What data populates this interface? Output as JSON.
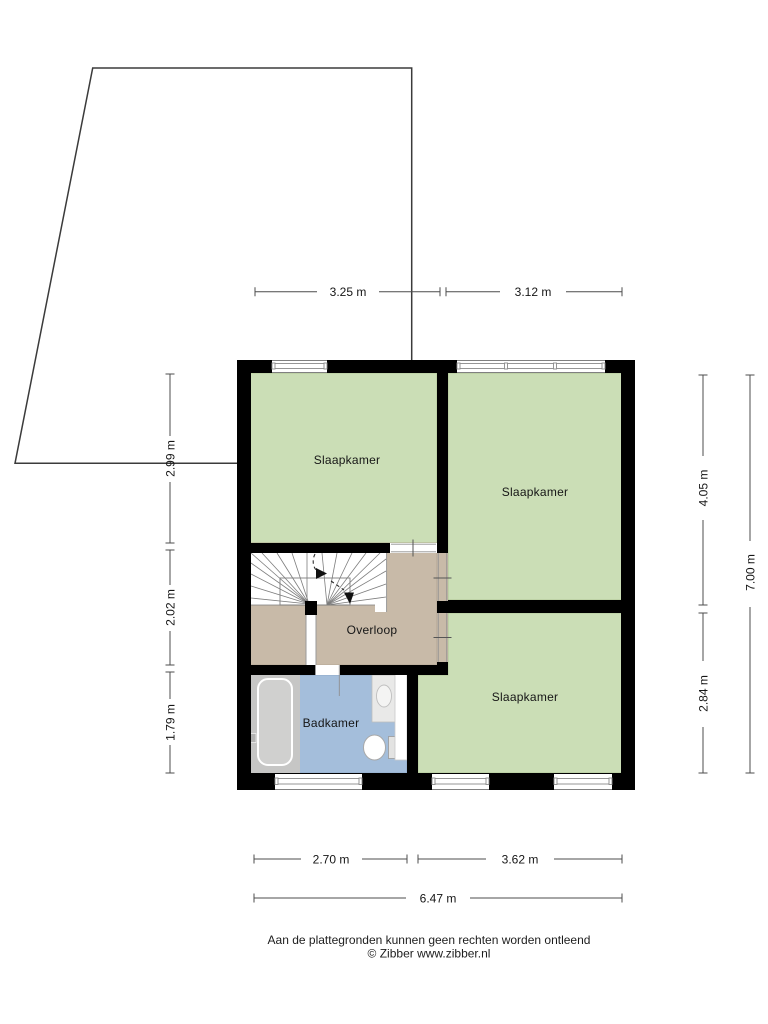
{
  "floorplan": {
    "rooms": [
      {
        "name": "slaapkamer-top-left",
        "label": "Slaapkamer"
      },
      {
        "name": "slaapkamer-top-right",
        "label": "Slaapkamer"
      },
      {
        "name": "slaapkamer-bottom-right",
        "label": "Slaapkamer"
      },
      {
        "name": "overloop",
        "label": "Overloop"
      },
      {
        "name": "badkamer",
        "label": "Badkamer"
      }
    ],
    "dimensions_top": [
      {
        "label": "3.25 m"
      },
      {
        "label": "3.12 m"
      }
    ],
    "dimensions_left": [
      {
        "label": "2.99 m"
      },
      {
        "label": "2.02 m"
      },
      {
        "label": "1.79 m"
      }
    ],
    "dimensions_right": [
      {
        "label": "4.05 m"
      },
      {
        "label": "2.84 m"
      },
      {
        "label": "7.00 m"
      }
    ],
    "dimensions_bottom": [
      {
        "label": "2.70 m"
      },
      {
        "label": "3.62 m"
      },
      {
        "label": "6.47 m"
      }
    ],
    "colors": {
      "wall": "#000000",
      "bedroom_green": "#cbdeb6",
      "landing_tan": "#c8baa8",
      "bathroom_blue": "#a4bedb",
      "fixture_gray": "#c6c6c5",
      "tub_inner_gray": "#d0d0cf",
      "counter_gray": "#e9e9e8",
      "dimension_line": "#4c4c4c",
      "lot_boundary": "#3b3b3b"
    }
  },
  "footer": {
    "disclaimer": "Aan de plattegronden kunnen geen rechten worden ontleend",
    "copyright": "© Zibber www.zibber.nl"
  }
}
